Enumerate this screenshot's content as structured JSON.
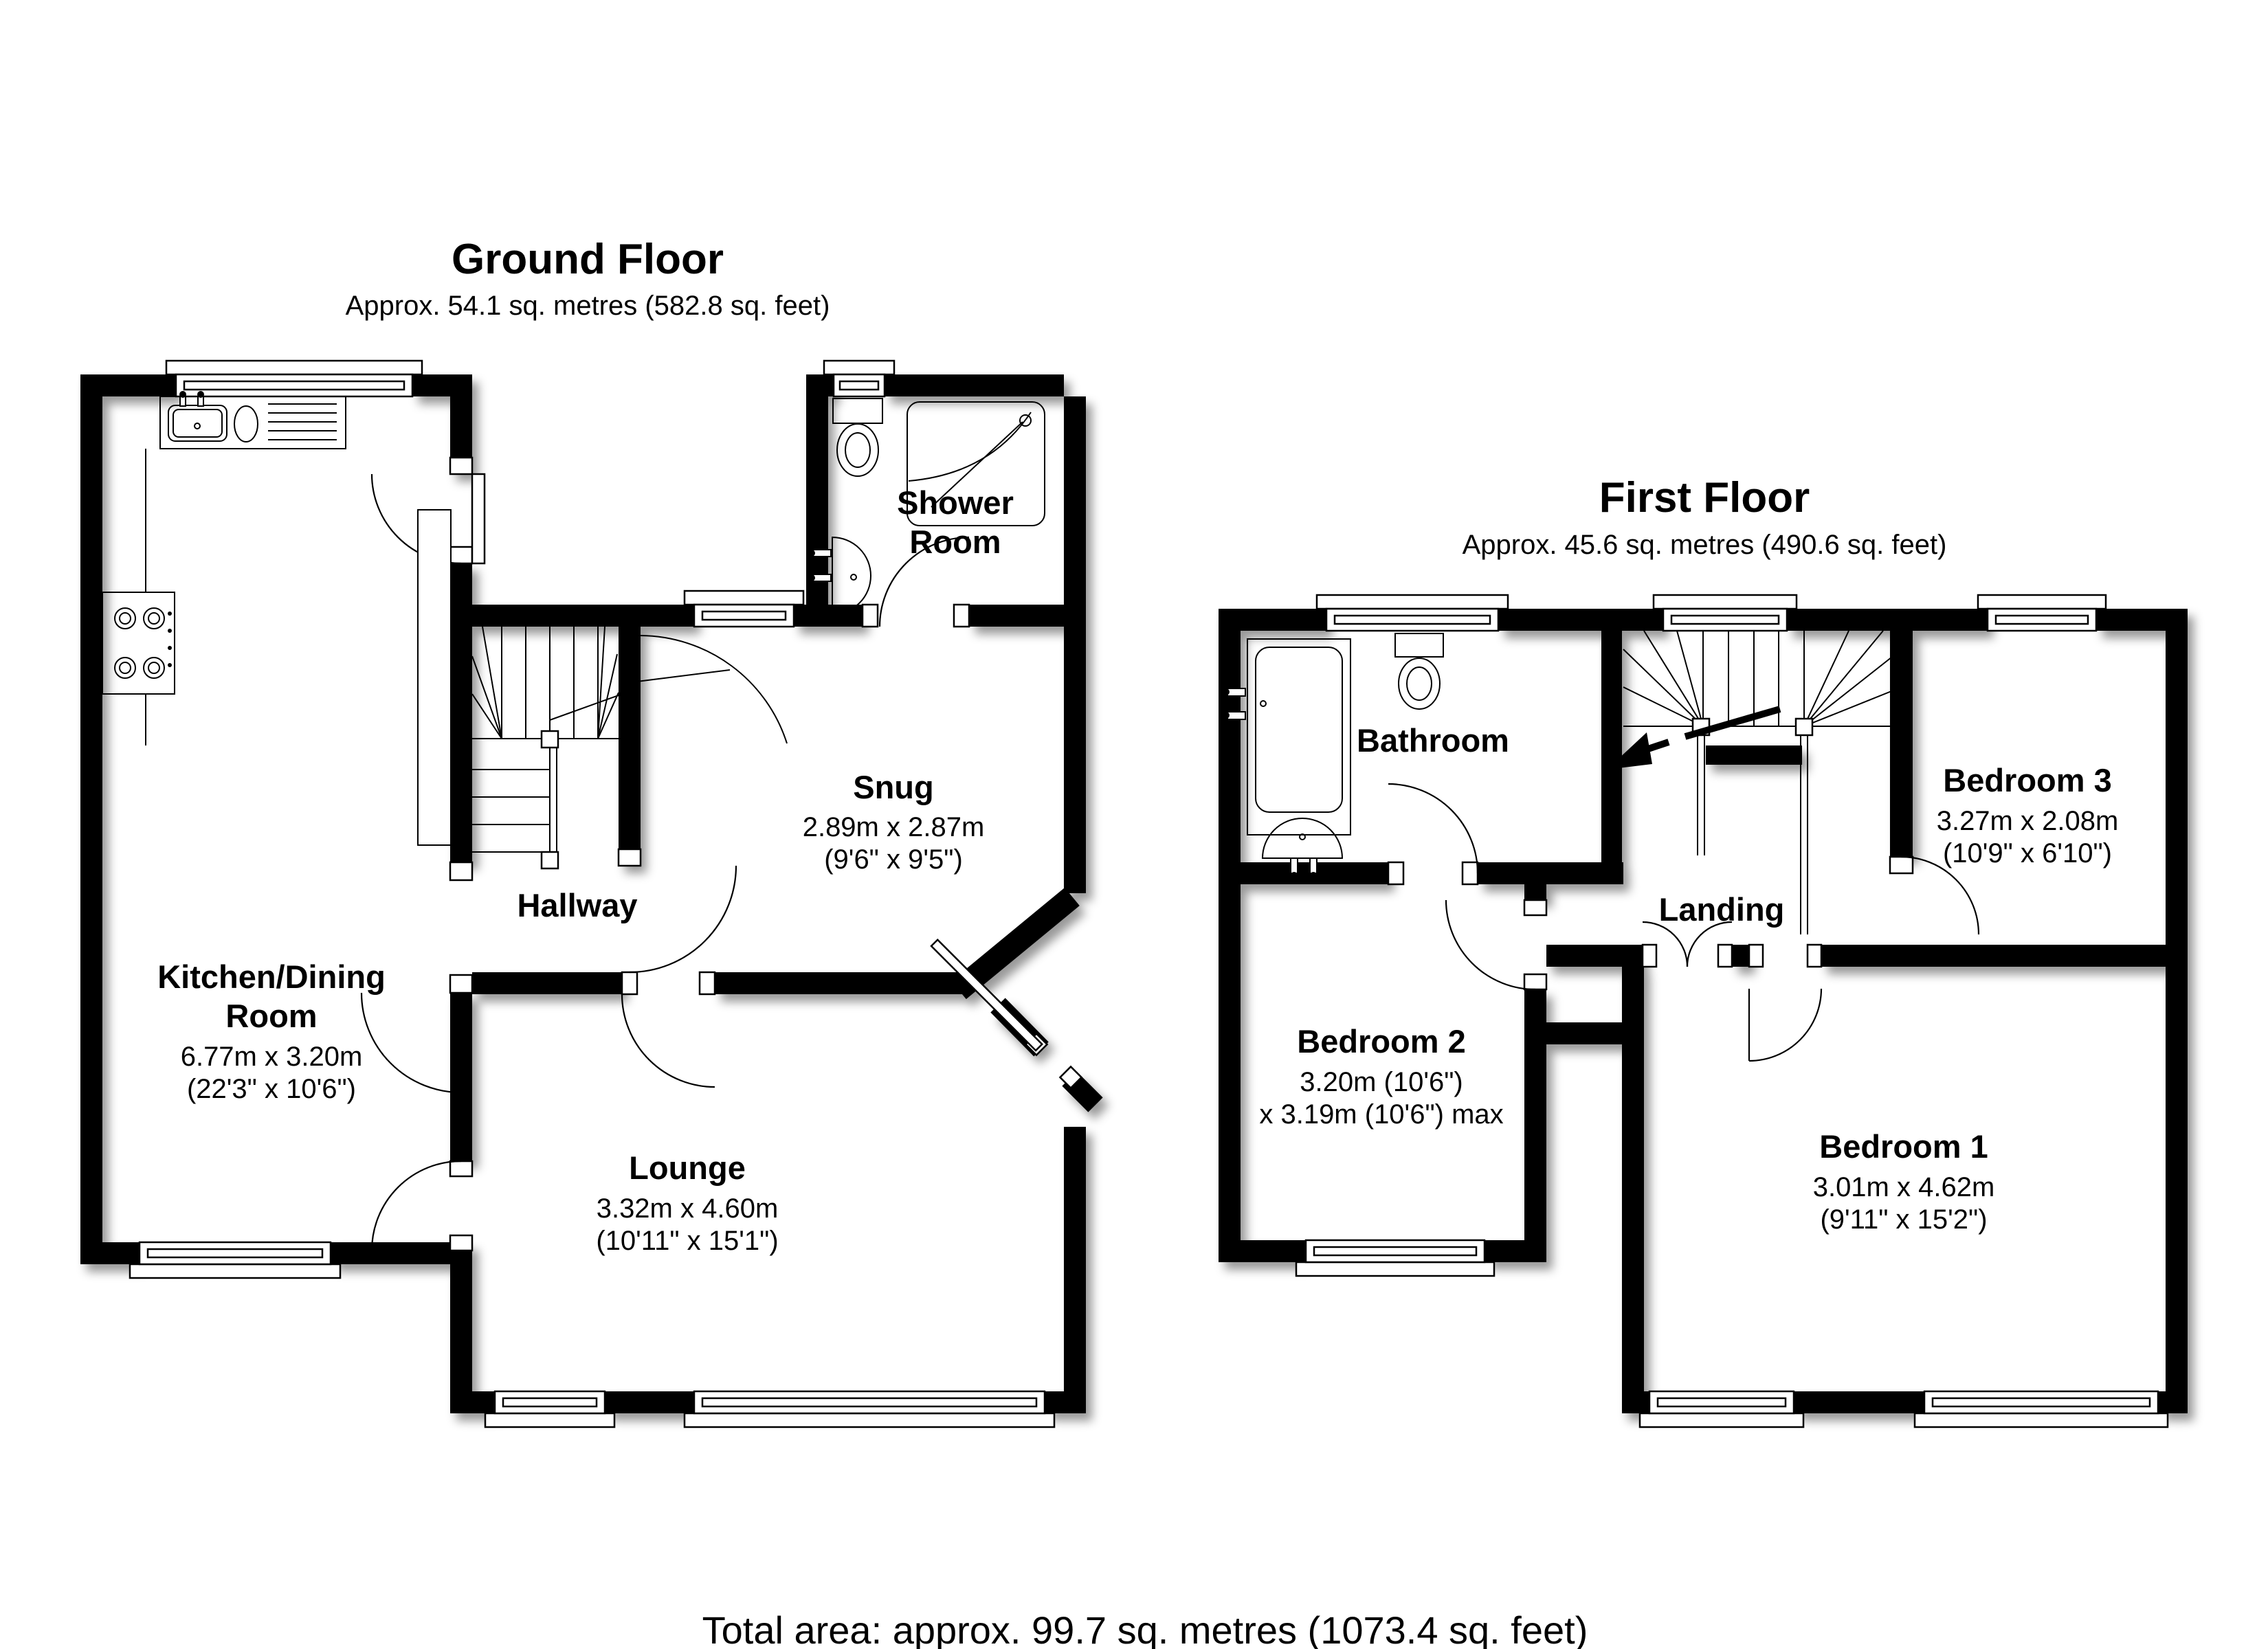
{
  "document": {
    "type": "floorplan",
    "total_area": "Total area: approx. 99.7 sq. metres (1073.4 sq. feet)"
  },
  "colors": {
    "wall": "#000000",
    "background": "#ffffff",
    "text": "#000000"
  },
  "floors": {
    "ground": {
      "title": "Ground Floor",
      "subtitle": "Approx. 54.1 sq. metres (582.8 sq. feet)"
    },
    "first": {
      "title": "First Floor",
      "subtitle": "Approx. 45.6 sq. metres (490.6 sq. feet)"
    }
  },
  "rooms": {
    "kitchen": {
      "name_line1": "Kitchen/Dining",
      "name_line2": "Room",
      "dims_metric": "6.77m x 3.20m",
      "dims_imperial": "(22'3\" x 10'6\")"
    },
    "shower": {
      "name_line1": "Shower",
      "name_line2": "Room"
    },
    "snug": {
      "name": "Snug",
      "dims_metric": "2.89m x 2.87m",
      "dims_imperial": "(9'6\" x 9'5\")"
    },
    "hallway": {
      "name": "Hallway"
    },
    "lounge": {
      "name": "Lounge",
      "dims_metric": "3.32m x 4.60m",
      "dims_imperial": "(10'11\" x 15'1\")"
    },
    "bathroom": {
      "name": "Bathroom"
    },
    "bedroom2": {
      "name": "Bedroom 2",
      "dims_metric": "3.20m (10'6\")",
      "dims_max": "x 3.19m (10'6\") max"
    },
    "landing": {
      "name": "Landing"
    },
    "bedroom3": {
      "name": "Bedroom 3",
      "dims_metric": "3.27m x 2.08m",
      "dims_imperial": "(10'9\" x 6'10\")"
    },
    "bedroom1": {
      "name": "Bedroom 1",
      "dims_metric": "3.01m x 4.62m",
      "dims_imperial": "(9'11\" x 15'2\")"
    }
  }
}
